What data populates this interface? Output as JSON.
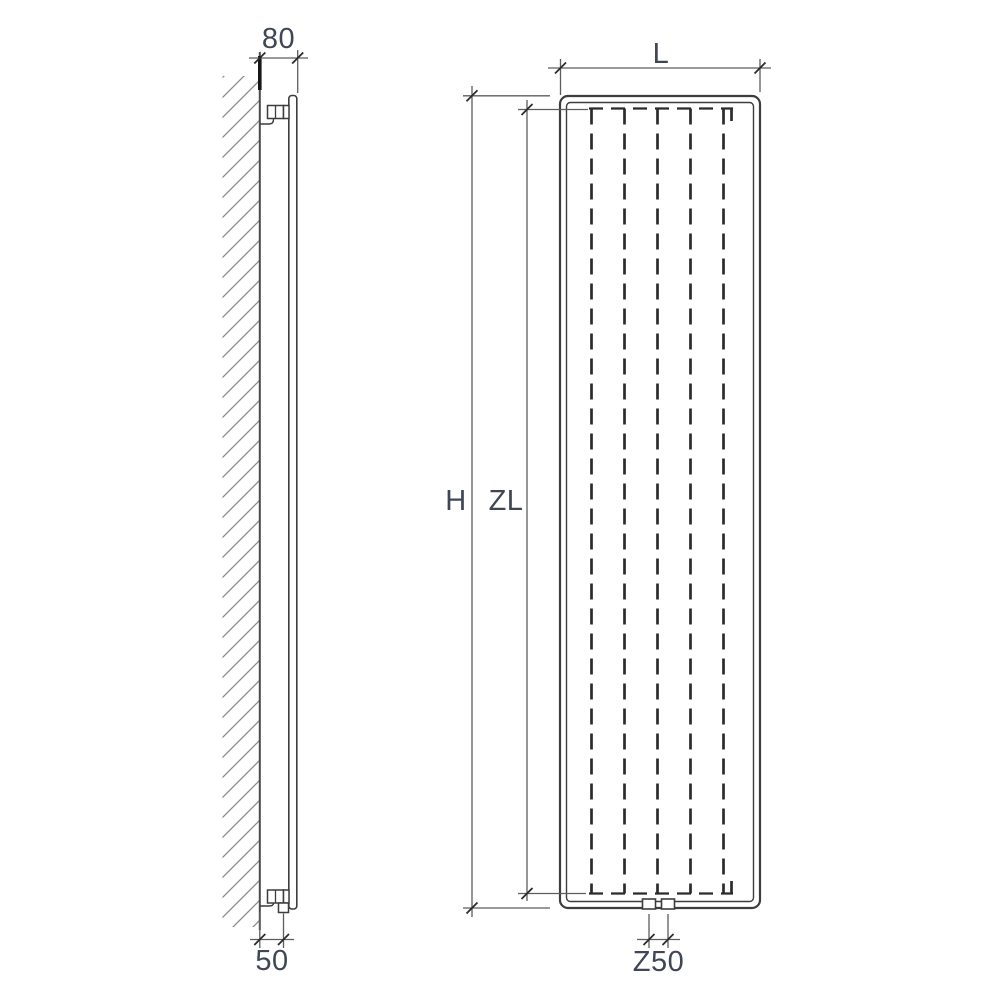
{
  "page": {
    "background_color": "#ffffff",
    "description": "Technical dimension drawing of a vertical panel radiator shown in side elevation (left) and front elevation (right)"
  },
  "colors": {
    "outline": "#3d3d3d",
    "dimension_lines": "#5d5d5d",
    "hidden_dashes": "#2b2b2b",
    "hatching": "#8a8a8a",
    "label_text": "#3f4654"
  },
  "side_view": {
    "name": "side-elevation",
    "dimensions": {
      "depth_label": "80",
      "connection_offset_label": "50"
    }
  },
  "front_view": {
    "name": "front-elevation",
    "dimensions": {
      "height_label": "H",
      "element_length_label": "ZL",
      "length_label": "L",
      "connection_spacing_label": "Z50"
    }
  }
}
